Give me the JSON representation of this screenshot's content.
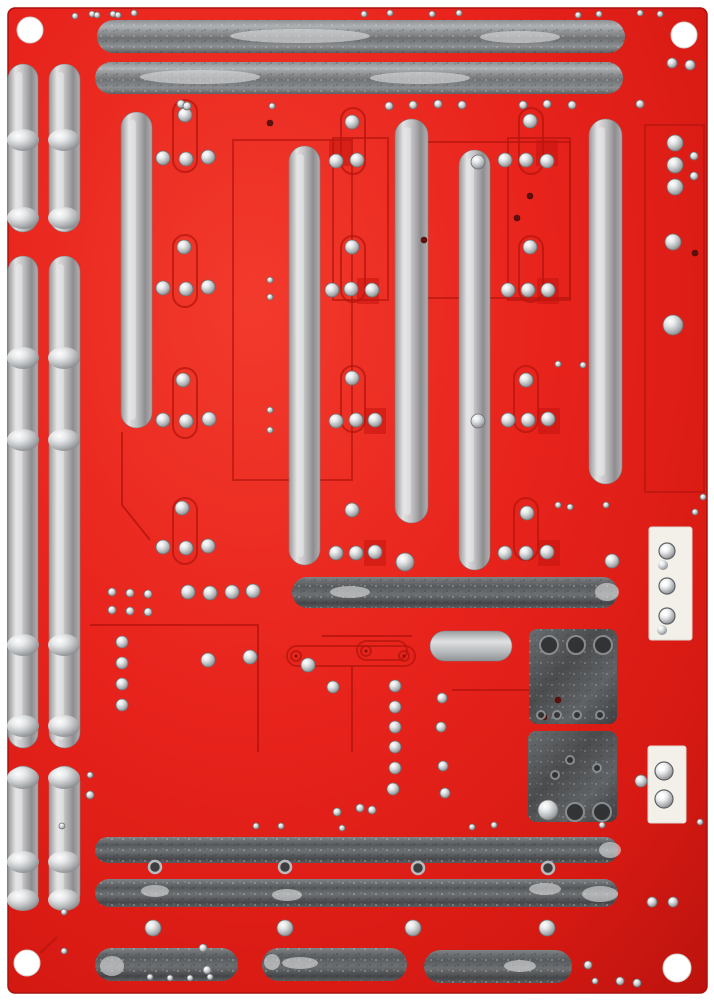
{
  "scene": {
    "description": "Photograph of the solder side of a red printed circuit board with tinned silver traces, solder joint domes, darker-red silkscreen outlines, two white wire connectors on the right edge and four white corner mounting holes"
  },
  "palette": {
    "background": "#ffffff",
    "board_red": "#e7231c",
    "board_red_light": "#f23a2c",
    "board_red_dark": "#bd130e",
    "outline_red": "#b5150e",
    "square_red": "#c4140e",
    "silver_bright": "#d9dbdc",
    "silver_mid": "#9b9ea1",
    "silver_dark": "#575a5c",
    "pad_dark": "#4a4c4e",
    "connector_white": "#f3f0ea",
    "hole_white": "#ffffff",
    "dark_hole": "#5f100c"
  },
  "pcb": {
    "board": {
      "x": 8,
      "y": 8,
      "w": 699,
      "h": 985,
      "rx": 7
    },
    "mounting_holes": [
      [
        30,
        30,
        13
      ],
      [
        684,
        35,
        13
      ],
      [
        27,
        963,
        13
      ],
      [
        677,
        968,
        14
      ]
    ],
    "bright_traces": [
      [
        8,
        64,
        30,
        168
      ],
      [
        49,
        64,
        31,
        168
      ],
      [
        8,
        256,
        30,
        492
      ],
      [
        49,
        256,
        31,
        492
      ],
      [
        8,
        766,
        30,
        144
      ],
      [
        49,
        766,
        31,
        144
      ],
      [
        121,
        112,
        31,
        316
      ],
      [
        289,
        146,
        31,
        419
      ],
      [
        395,
        119,
        33,
        404
      ],
      [
        459,
        150,
        31,
        420
      ],
      [
        589,
        119,
        33,
        365
      ]
    ],
    "bright_pads": [
      [
        430,
        631,
        82,
        30
      ]
    ],
    "mid_traces": [
      [
        97,
        20,
        528,
        33
      ],
      [
        95,
        62,
        528,
        32
      ]
    ],
    "dark_traces": [
      [
        292,
        577,
        326,
        31
      ],
      [
        95,
        837,
        523,
        26
      ],
      [
        95,
        879,
        523,
        28
      ],
      [
        95,
        948,
        143,
        33
      ],
      [
        262,
        948,
        145,
        33
      ],
      [
        424,
        950,
        148,
        33
      ]
    ],
    "dark_pads": [
      [
        529,
        629,
        88,
        95
      ],
      [
        528,
        731,
        89,
        91
      ]
    ],
    "dark_squares": [
      [
        329,
        140
      ],
      [
        536,
        140
      ],
      [
        357,
        278
      ],
      [
        537,
        278
      ],
      [
        364,
        408
      ],
      [
        538,
        408
      ],
      [
        364,
        540
      ],
      [
        538,
        540
      ]
    ],
    "outline_rects": [
      [
        233,
        140,
        119,
        340
      ],
      [
        333,
        138,
        55,
        162
      ],
      [
        508,
        138,
        62,
        162
      ],
      [
        420,
        142,
        150,
        156
      ],
      [
        645,
        125,
        59,
        367
      ]
    ],
    "outline_capsules": [
      [
        173,
        100,
        24,
        72
      ],
      [
        173,
        235,
        24,
        72
      ],
      [
        173,
        368,
        24,
        70
      ],
      [
        173,
        498,
        24,
        66
      ],
      [
        341,
        108,
        24,
        66
      ],
      [
        519,
        108,
        24,
        66
      ],
      [
        341,
        236,
        24,
        66
      ],
      [
        519,
        236,
        24,
        66
      ],
      [
        341,
        366,
        24,
        66
      ],
      [
        514,
        366,
        24,
        66
      ],
      [
        514,
        498,
        24,
        62
      ],
      [
        287,
        646,
        128,
        20
      ],
      [
        357,
        641,
        50,
        19
      ]
    ],
    "outline_lines": [
      [
        [
          90,
          625
        ],
        [
          258,
          625
        ],
        [
          258,
          752
        ]
      ],
      [
        [
          322,
          636
        ],
        [
          412,
          636
        ]
      ],
      [
        [
          352,
          666
        ],
        [
          352,
          752
        ]
      ],
      [
        [
          452,
          690
        ],
        [
          530,
          690
        ]
      ],
      [
        [
          122,
          432
        ],
        [
          122,
          505
        ],
        [
          150,
          540
        ]
      ],
      [
        [
          57,
          937
        ],
        [
          40,
          953
        ]
      ]
    ],
    "hole_pads": [
      [
        296,
        656
      ],
      [
        404,
        656
      ],
      [
        366,
        651
      ]
    ],
    "solder_blobs": [
      [
        23,
        140
      ],
      [
        64,
        140
      ],
      [
        23,
        218
      ],
      [
        64,
        218
      ],
      [
        23,
        358
      ],
      [
        64,
        358
      ],
      [
        23,
        440
      ],
      [
        64,
        440
      ],
      [
        23,
        645
      ],
      [
        64,
        645
      ],
      [
        23,
        726
      ],
      [
        64,
        726
      ],
      [
        23,
        778
      ],
      [
        64,
        778
      ],
      [
        23,
        862
      ],
      [
        64,
        862
      ],
      [
        23,
        900
      ],
      [
        64,
        900
      ]
    ],
    "glints": [
      [
        300,
        36,
        70,
        7
      ],
      [
        520,
        37,
        40,
        6
      ],
      [
        200,
        77,
        60,
        7
      ],
      [
        420,
        78,
        50,
        6
      ],
      [
        350,
        592,
        20,
        6
      ],
      [
        607,
        592,
        12,
        9
      ],
      [
        155,
        891,
        14,
        6
      ],
      [
        287,
        895,
        15,
        6
      ],
      [
        545,
        889,
        16,
        6
      ],
      [
        600,
        894,
        18,
        8
      ],
      [
        610,
        850,
        11,
        8
      ],
      [
        112,
        966,
        12,
        10
      ],
      [
        272,
        962,
        8,
        8
      ],
      [
        300,
        963,
        18,
        6
      ],
      [
        520,
        966,
        16,
        6
      ]
    ],
    "solder_dots": [
      [
        163,
        158,
        7
      ],
      [
        186,
        159,
        7
      ],
      [
        208,
        157,
        7
      ],
      [
        185,
        115,
        7
      ],
      [
        163,
        288,
        7
      ],
      [
        186,
        289,
        7
      ],
      [
        208,
        287,
        7
      ],
      [
        184,
        247,
        7
      ],
      [
        163,
        420,
        7
      ],
      [
        186,
        421,
        7
      ],
      [
        209,
        419,
        7
      ],
      [
        183,
        380,
        7
      ],
      [
        163,
        547,
        7
      ],
      [
        186,
        548,
        7
      ],
      [
        208,
        546,
        7
      ],
      [
        182,
        508,
        7
      ],
      [
        336,
        161,
        7
      ],
      [
        357,
        160,
        7
      ],
      [
        352,
        122,
        7
      ],
      [
        332,
        290,
        7
      ],
      [
        351,
        289,
        7
      ],
      [
        372,
        290,
        7
      ],
      [
        352,
        247,
        7
      ],
      [
        336,
        421,
        7
      ],
      [
        356,
        420,
        7
      ],
      [
        375,
        420,
        7
      ],
      [
        352,
        378,
        7
      ],
      [
        336,
        553,
        7
      ],
      [
        356,
        553,
        7
      ],
      [
        375,
        552,
        7
      ],
      [
        352,
        510,
        7
      ],
      [
        405,
        562,
        9
      ],
      [
        505,
        160,
        7
      ],
      [
        526,
        160,
        7
      ],
      [
        547,
        161,
        7
      ],
      [
        478,
        162,
        7
      ],
      [
        530,
        121,
        7
      ],
      [
        508,
        290,
        7
      ],
      [
        528,
        290,
        7
      ],
      [
        548,
        290,
        7
      ],
      [
        530,
        247,
        7
      ],
      [
        508,
        420,
        7
      ],
      [
        528,
        420,
        7
      ],
      [
        548,
        419,
        7
      ],
      [
        526,
        380,
        7
      ],
      [
        478,
        421,
        7
      ],
      [
        505,
        553,
        7
      ],
      [
        526,
        553,
        7
      ],
      [
        547,
        552,
        7
      ],
      [
        527,
        513,
        7
      ],
      [
        612,
        561,
        7
      ],
      [
        606,
        505,
        3
      ],
      [
        675,
        143,
        8
      ],
      [
        675,
        165,
        8
      ],
      [
        675,
        187,
        8
      ],
      [
        694,
        156,
        4
      ],
      [
        694,
        176,
        4
      ],
      [
        673,
        242,
        8
      ],
      [
        673,
        325,
        10
      ],
      [
        672,
        63,
        5
      ],
      [
        690,
        65,
        5
      ],
      [
        188,
        592,
        7
      ],
      [
        210,
        593,
        7
      ],
      [
        232,
        592,
        7
      ],
      [
        253,
        591,
        7
      ],
      [
        395,
        686,
        6
      ],
      [
        395,
        707,
        6
      ],
      [
        395,
        727,
        6
      ],
      [
        395,
        747,
        6
      ],
      [
        395,
        768,
        6
      ],
      [
        393,
        789,
        6
      ],
      [
        442,
        698,
        5
      ],
      [
        441,
        727,
        5
      ],
      [
        443,
        766,
        5
      ],
      [
        445,
        793,
        5
      ],
      [
        333,
        687,
        6
      ],
      [
        308,
        665,
        7
      ],
      [
        208,
        660,
        7
      ],
      [
        250,
        657,
        7
      ],
      [
        122,
        642,
        6
      ],
      [
        122,
        663,
        6
      ],
      [
        122,
        684,
        6
      ],
      [
        122,
        705,
        6
      ],
      [
        112,
        592,
        4
      ],
      [
        130,
        593,
        4
      ],
      [
        148,
        594,
        4
      ],
      [
        112,
        610,
        4
      ],
      [
        130,
        611,
        4
      ],
      [
        148,
        612,
        4
      ],
      [
        153,
        928,
        8
      ],
      [
        285,
        928,
        8
      ],
      [
        413,
        928,
        8
      ],
      [
        547,
        928,
        8
      ],
      [
        548,
        810,
        10
      ],
      [
        360,
        808,
        4
      ],
      [
        372,
        810,
        4
      ],
      [
        337,
        812,
        4
      ],
      [
        652,
        902,
        5
      ],
      [
        673,
        902,
        5
      ],
      [
        641,
        781,
        6
      ],
      [
        90,
        795,
        4
      ],
      [
        90,
        775,
        3
      ],
      [
        64,
        912,
        3
      ],
      [
        64,
        951,
        3
      ],
      [
        62,
        826,
        3
      ],
      [
        203,
        948,
        4
      ],
      [
        207,
        970,
        4
      ],
      [
        588,
        965,
        4
      ],
      [
        595,
        981,
        3
      ],
      [
        620,
        981,
        4
      ],
      [
        637,
        983,
        4
      ],
      [
        558,
        505,
        3
      ],
      [
        570,
        507,
        3
      ],
      [
        695,
        512,
        3
      ],
      [
        703,
        497,
        3
      ],
      [
        75,
        16,
        3
      ],
      [
        92,
        14,
        3
      ],
      [
        97,
        15,
        3
      ],
      [
        113,
        14,
        3
      ],
      [
        118,
        15,
        3
      ],
      [
        134,
        13,
        3
      ],
      [
        364,
        14,
        3
      ],
      [
        390,
        13,
        3
      ],
      [
        432,
        14,
        3
      ],
      [
        459,
        13,
        3
      ],
      [
        578,
        15,
        3
      ],
      [
        599,
        14,
        3
      ],
      [
        640,
        13,
        3
      ],
      [
        660,
        14,
        3
      ],
      [
        181,
        104,
        4
      ],
      [
        187,
        106,
        4
      ],
      [
        272,
        106,
        3
      ],
      [
        389,
        106,
        4
      ],
      [
        413,
        105,
        4
      ],
      [
        438,
        104,
        4
      ],
      [
        462,
        105,
        4
      ],
      [
        523,
        105,
        4
      ],
      [
        547,
        104,
        4
      ],
      [
        572,
        105,
        4
      ],
      [
        640,
        104,
        4
      ],
      [
        270,
        280,
        3
      ],
      [
        270,
        297,
        3
      ],
      [
        558,
        364,
        3
      ],
      [
        583,
        365,
        3
      ],
      [
        270,
        410,
        3
      ],
      [
        270,
        430,
        3
      ],
      [
        150,
        977,
        3
      ],
      [
        170,
        978,
        3
      ],
      [
        190,
        978,
        3
      ],
      [
        210,
        977,
        3
      ],
      [
        256,
        826,
        3
      ],
      [
        281,
        826,
        3
      ],
      [
        342,
        828,
        3
      ],
      [
        472,
        827,
        3
      ],
      [
        494,
        825,
        3
      ],
      [
        602,
        825,
        3
      ],
      [
        700,
        822,
        3
      ]
    ],
    "dark_dots": [
      [
        270,
        123,
        3
      ],
      [
        530,
        196,
        3
      ],
      [
        695,
        253,
        3
      ],
      [
        424,
        240,
        3
      ],
      [
        517,
        218,
        3
      ],
      [
        544,
        717,
        3
      ],
      [
        558,
        700,
        3
      ]
    ],
    "via_rings": [
      [
        155,
        867,
        6
      ],
      [
        285,
        867,
        6
      ],
      [
        418,
        868,
        6
      ],
      [
        548,
        868,
        6
      ]
    ],
    "pad_rings": [
      [
        549,
        645,
        9
      ],
      [
        576,
        645,
        9
      ],
      [
        603,
        645,
        9
      ],
      [
        575,
        812,
        9
      ],
      [
        602,
        812,
        9
      ],
      [
        541,
        715,
        4
      ],
      [
        557,
        715,
        4
      ],
      [
        577,
        715,
        4
      ],
      [
        600,
        715,
        4
      ],
      [
        570,
        760,
        4
      ],
      [
        597,
        768,
        4
      ],
      [
        555,
        775,
        4
      ]
    ],
    "connectors": [
      {
        "rect": [
          649,
          527,
          43,
          113
        ],
        "pins": [
          [
            667,
            551,
            8
          ],
          [
            667,
            586,
            8
          ],
          [
            667,
            616,
            8
          ]
        ],
        "blobs": [
          [
            663,
            565,
            5
          ],
          [
            662,
            630,
            5
          ]
        ]
      },
      {
        "rect": [
          648,
          746,
          38,
          77
        ],
        "pins": [
          [
            664,
            771,
            9
          ],
          [
            664,
            799,
            9
          ]
        ],
        "blobs": []
      }
    ]
  }
}
